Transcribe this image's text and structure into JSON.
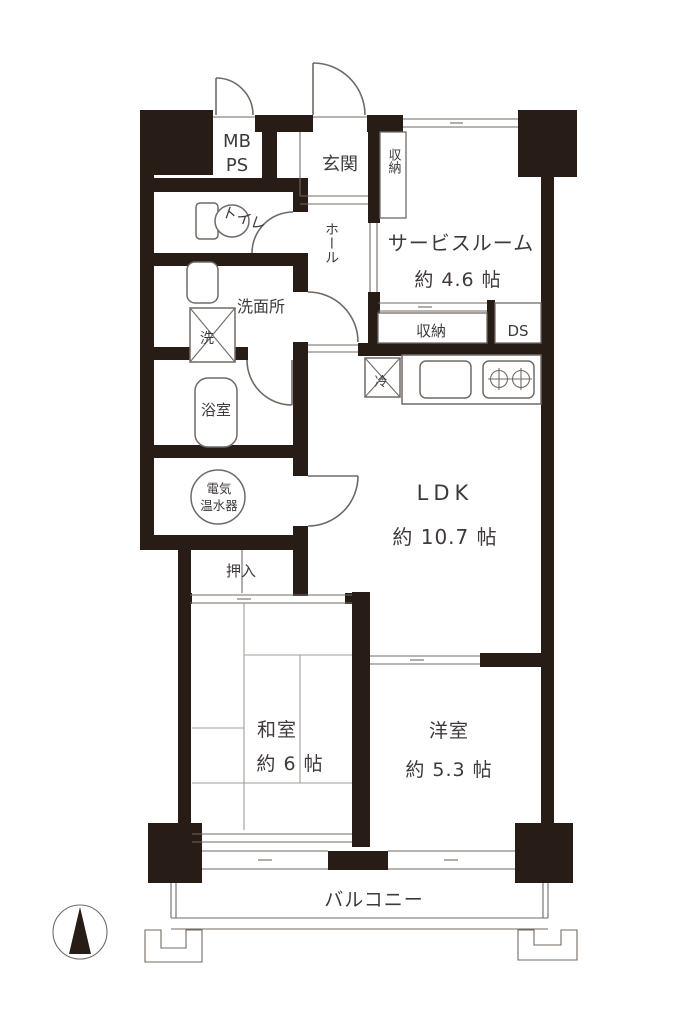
{
  "title": "apartment-floor-plan",
  "colors": {
    "wall": "#281c16",
    "line": "#6f6a66",
    "text": "#3f3a39",
    "tatami": "#a39d99",
    "bg": "#ffffff"
  },
  "labels": {
    "mb": "MB",
    "ps": "PS",
    "genkan": "玄関",
    "entrance_closet": "収納",
    "toilet": "トイレ",
    "hall": "ホール",
    "service_room": "サービスルーム",
    "service_room_size": "約 4.6 帖",
    "service_closet_side": "収納",
    "service_closet_bottom": "収納",
    "ds": "DS",
    "washroom": "洗面所",
    "washer": "洗",
    "bathroom": "浴室",
    "fridge": "冷",
    "ldk": "LDK",
    "ldk_size": "約 10.7 帖",
    "water_heater_line1": "電気",
    "water_heater_line2": "温水器",
    "oshiire": "押入",
    "washitsu": "和室",
    "washitsu_size": "約 6 帖",
    "youshitsu": "洋室",
    "youshitsu_size": "約 5.3 帖",
    "balcony": "バルコニー"
  }
}
